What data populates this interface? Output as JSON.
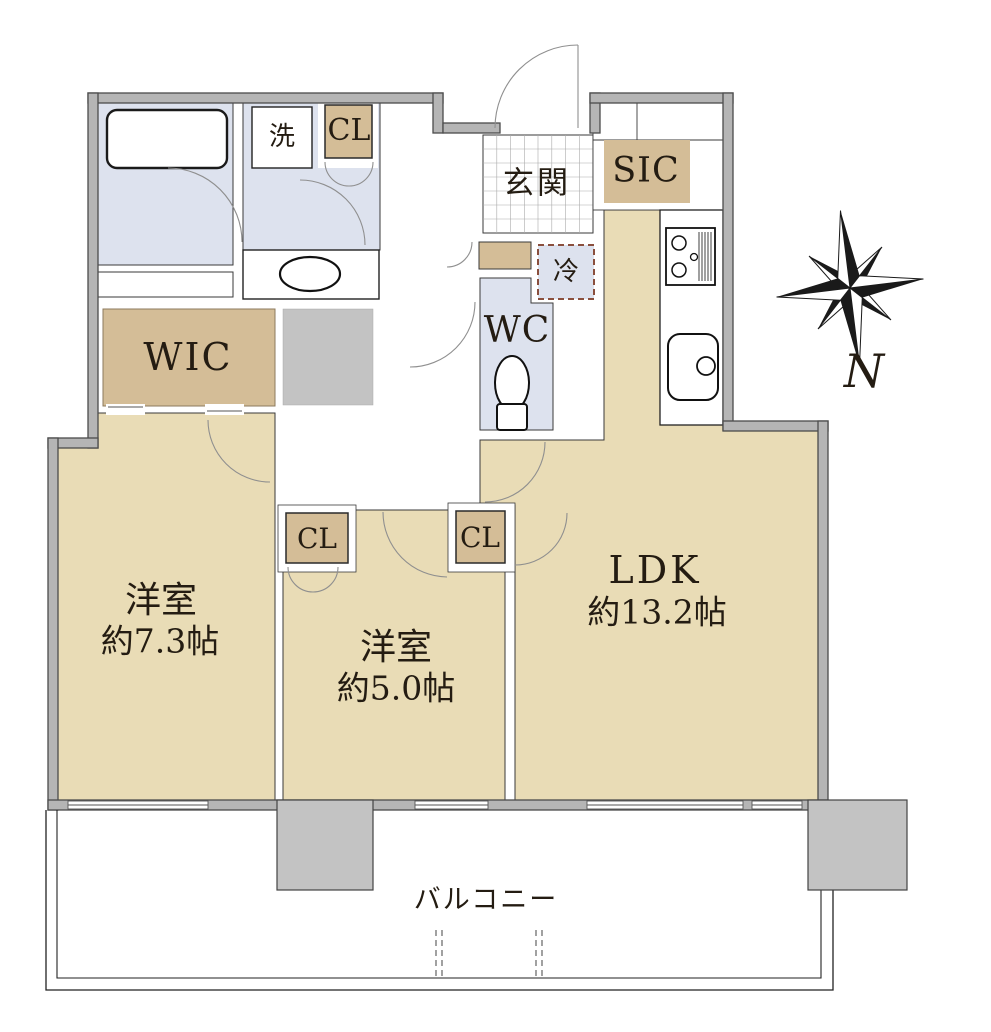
{
  "plan_title": "2LDK apartment floor plan",
  "rooms": {
    "bedroom1": {
      "name": "洋室",
      "area": "約7.3帖"
    },
    "bedroom2": {
      "name": "洋室",
      "area": "約5.0帖"
    },
    "ldk": {
      "name": "LDK",
      "area": "約13.2帖"
    }
  },
  "labels": {
    "entrance": "玄関",
    "shoe_in_closet": "SIC",
    "laundry": "洗",
    "fridge": "冷",
    "toilet": "WC",
    "walk_in_closet": "WIC",
    "closets": [
      "CL",
      "CL",
      "CL"
    ],
    "balcony": "バルコニー"
  },
  "compass": {
    "north_label": "N"
  },
  "colors": {
    "floor": "#e9dcb6",
    "closet": "#d4bd97",
    "wet_area": "#dde2ee",
    "wall": "#b5b5b5",
    "pillar": "#c3c3c3",
    "text": "#241c12"
  }
}
